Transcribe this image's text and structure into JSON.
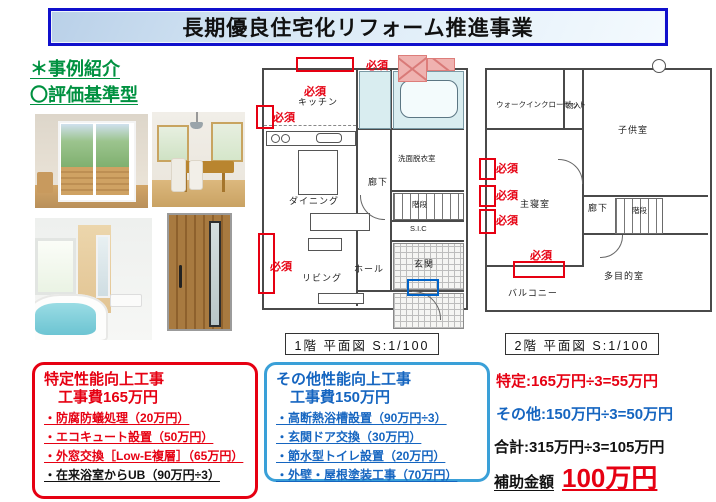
{
  "banner": {
    "title": "長期優良住宅化リフォーム推進事業"
  },
  "intro": {
    "line1": "＊事例紹介",
    "line2": "〇評価基準型"
  },
  "floorplan1": {
    "caption": "1階 平面図 S:1/100",
    "required_label": "必須",
    "rooms": {
      "kitchen": "キッチン",
      "dining": "ダイニング",
      "living": "リビング",
      "washroom": "洗面脱衣室",
      "hallway": "廊下",
      "stairs": "階段",
      "shoe_closet": "S.I.C",
      "entrance": "玄関",
      "hall": "ホール"
    }
  },
  "floorplan2": {
    "caption": "2階 平面図 S:1/100",
    "required_label": "必須",
    "rooms": {
      "walk_in_closet": "ウォークインクローゼット",
      "storage": "物入",
      "kids_room": "子供室",
      "master_bedroom": "主寝室",
      "hallway": "廊下",
      "stairs": "階段",
      "multipurpose_room": "多目的室",
      "balcony": "バルコニー"
    }
  },
  "specific_box": {
    "title": "特定性能向上工事",
    "subtitle": "工事費165万円",
    "items": [
      "・防腐防蟻処理（20万円）",
      "・エコキュート設置（50万円）",
      "・外窓交換［Low-E複層］（65万円）",
      "・在来浴室からUB（90万円÷3）"
    ]
  },
  "other_box": {
    "title": "その他性能向上工事",
    "subtitle": "工事費150万円",
    "items": [
      "・高断熱浴槽設置（90万円÷3）",
      "・玄関ドア交換（30万円）",
      "・節水型トイレ設置（20万円）",
      "・外壁・屋根塗装工事（70万円）"
    ]
  },
  "summary": {
    "specific": "特定:165万円÷3=55万円",
    "other": "その他:150万円÷3=50万円",
    "total": "合計:315万円÷3=105万円",
    "subsidy_label": "補助金額",
    "subsidy_amount": "100万円"
  },
  "colors": {
    "accent_red": "#e60012",
    "accent_blue": "#1565c0",
    "box_blue_border": "#3aa0d8",
    "green": "#009140",
    "banner_border": "#1010cc"
  }
}
